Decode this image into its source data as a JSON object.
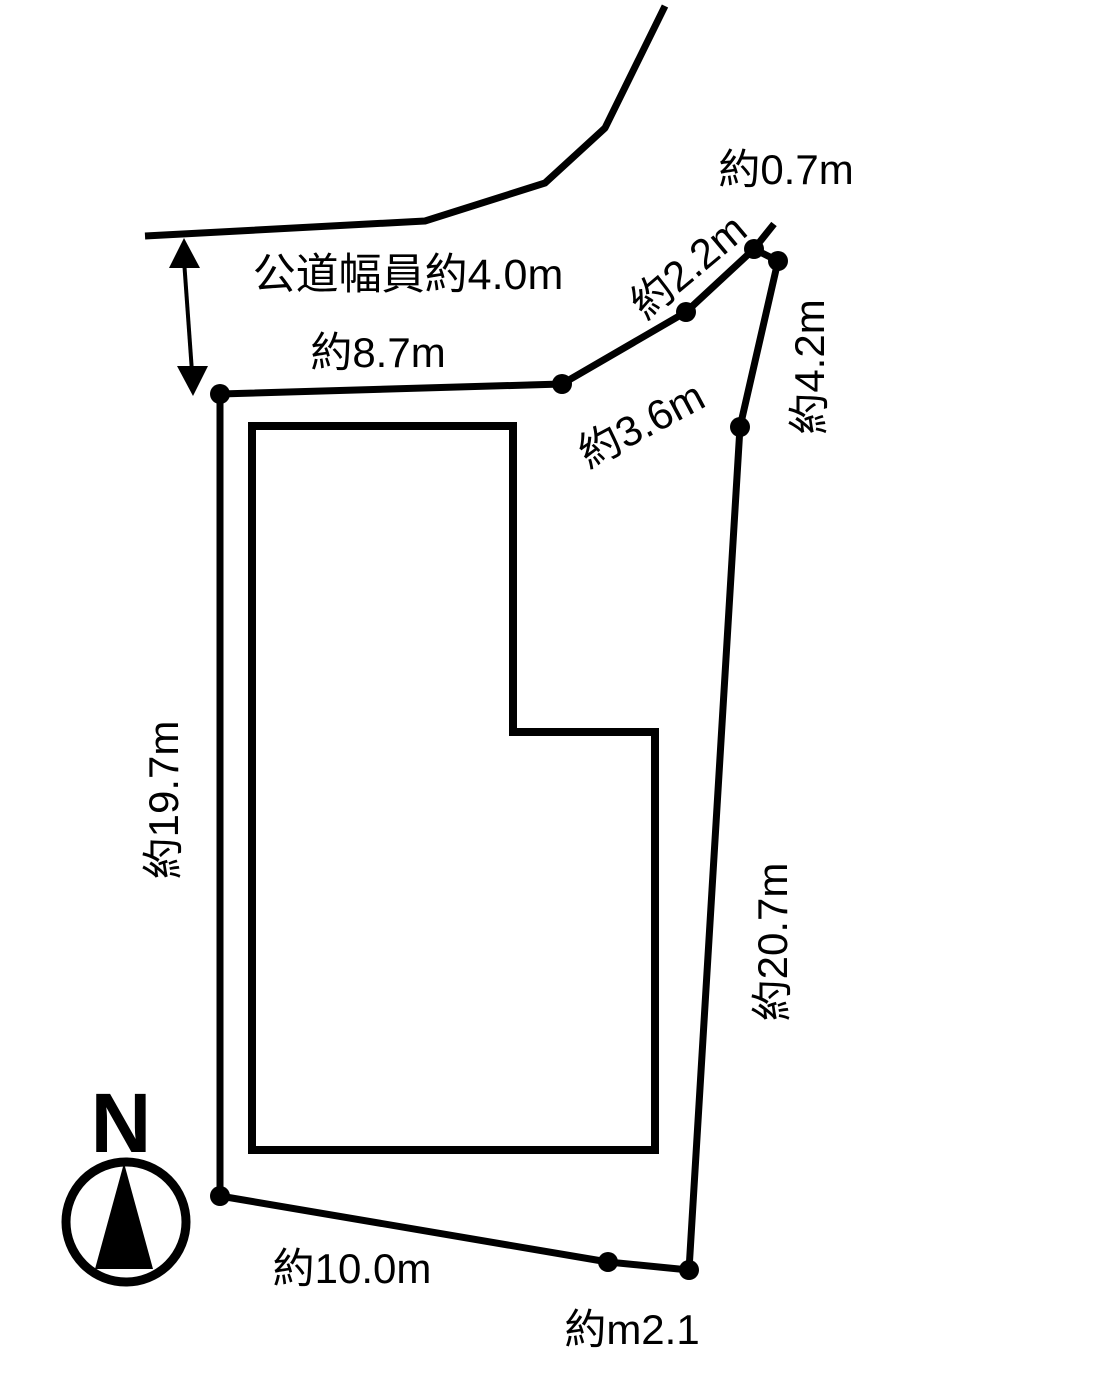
{
  "diagram": {
    "background_color": "#ffffff",
    "line_color": "#000000",
    "labels": {
      "road_width": "公道幅員約4.0m",
      "top_edge": "約8.7m",
      "edge_3_6": "約3.6m",
      "edge_2_2": "約2.2m",
      "edge_0_7": "約0.7m",
      "edge_4_2": "約4.2m",
      "left_edge": "約19.7m",
      "right_edge": "約20.7m",
      "bottom_edge": "約10.0m",
      "bottom_right_edge": "約m2.1"
    },
    "compass": {
      "north_label": "N"
    }
  }
}
